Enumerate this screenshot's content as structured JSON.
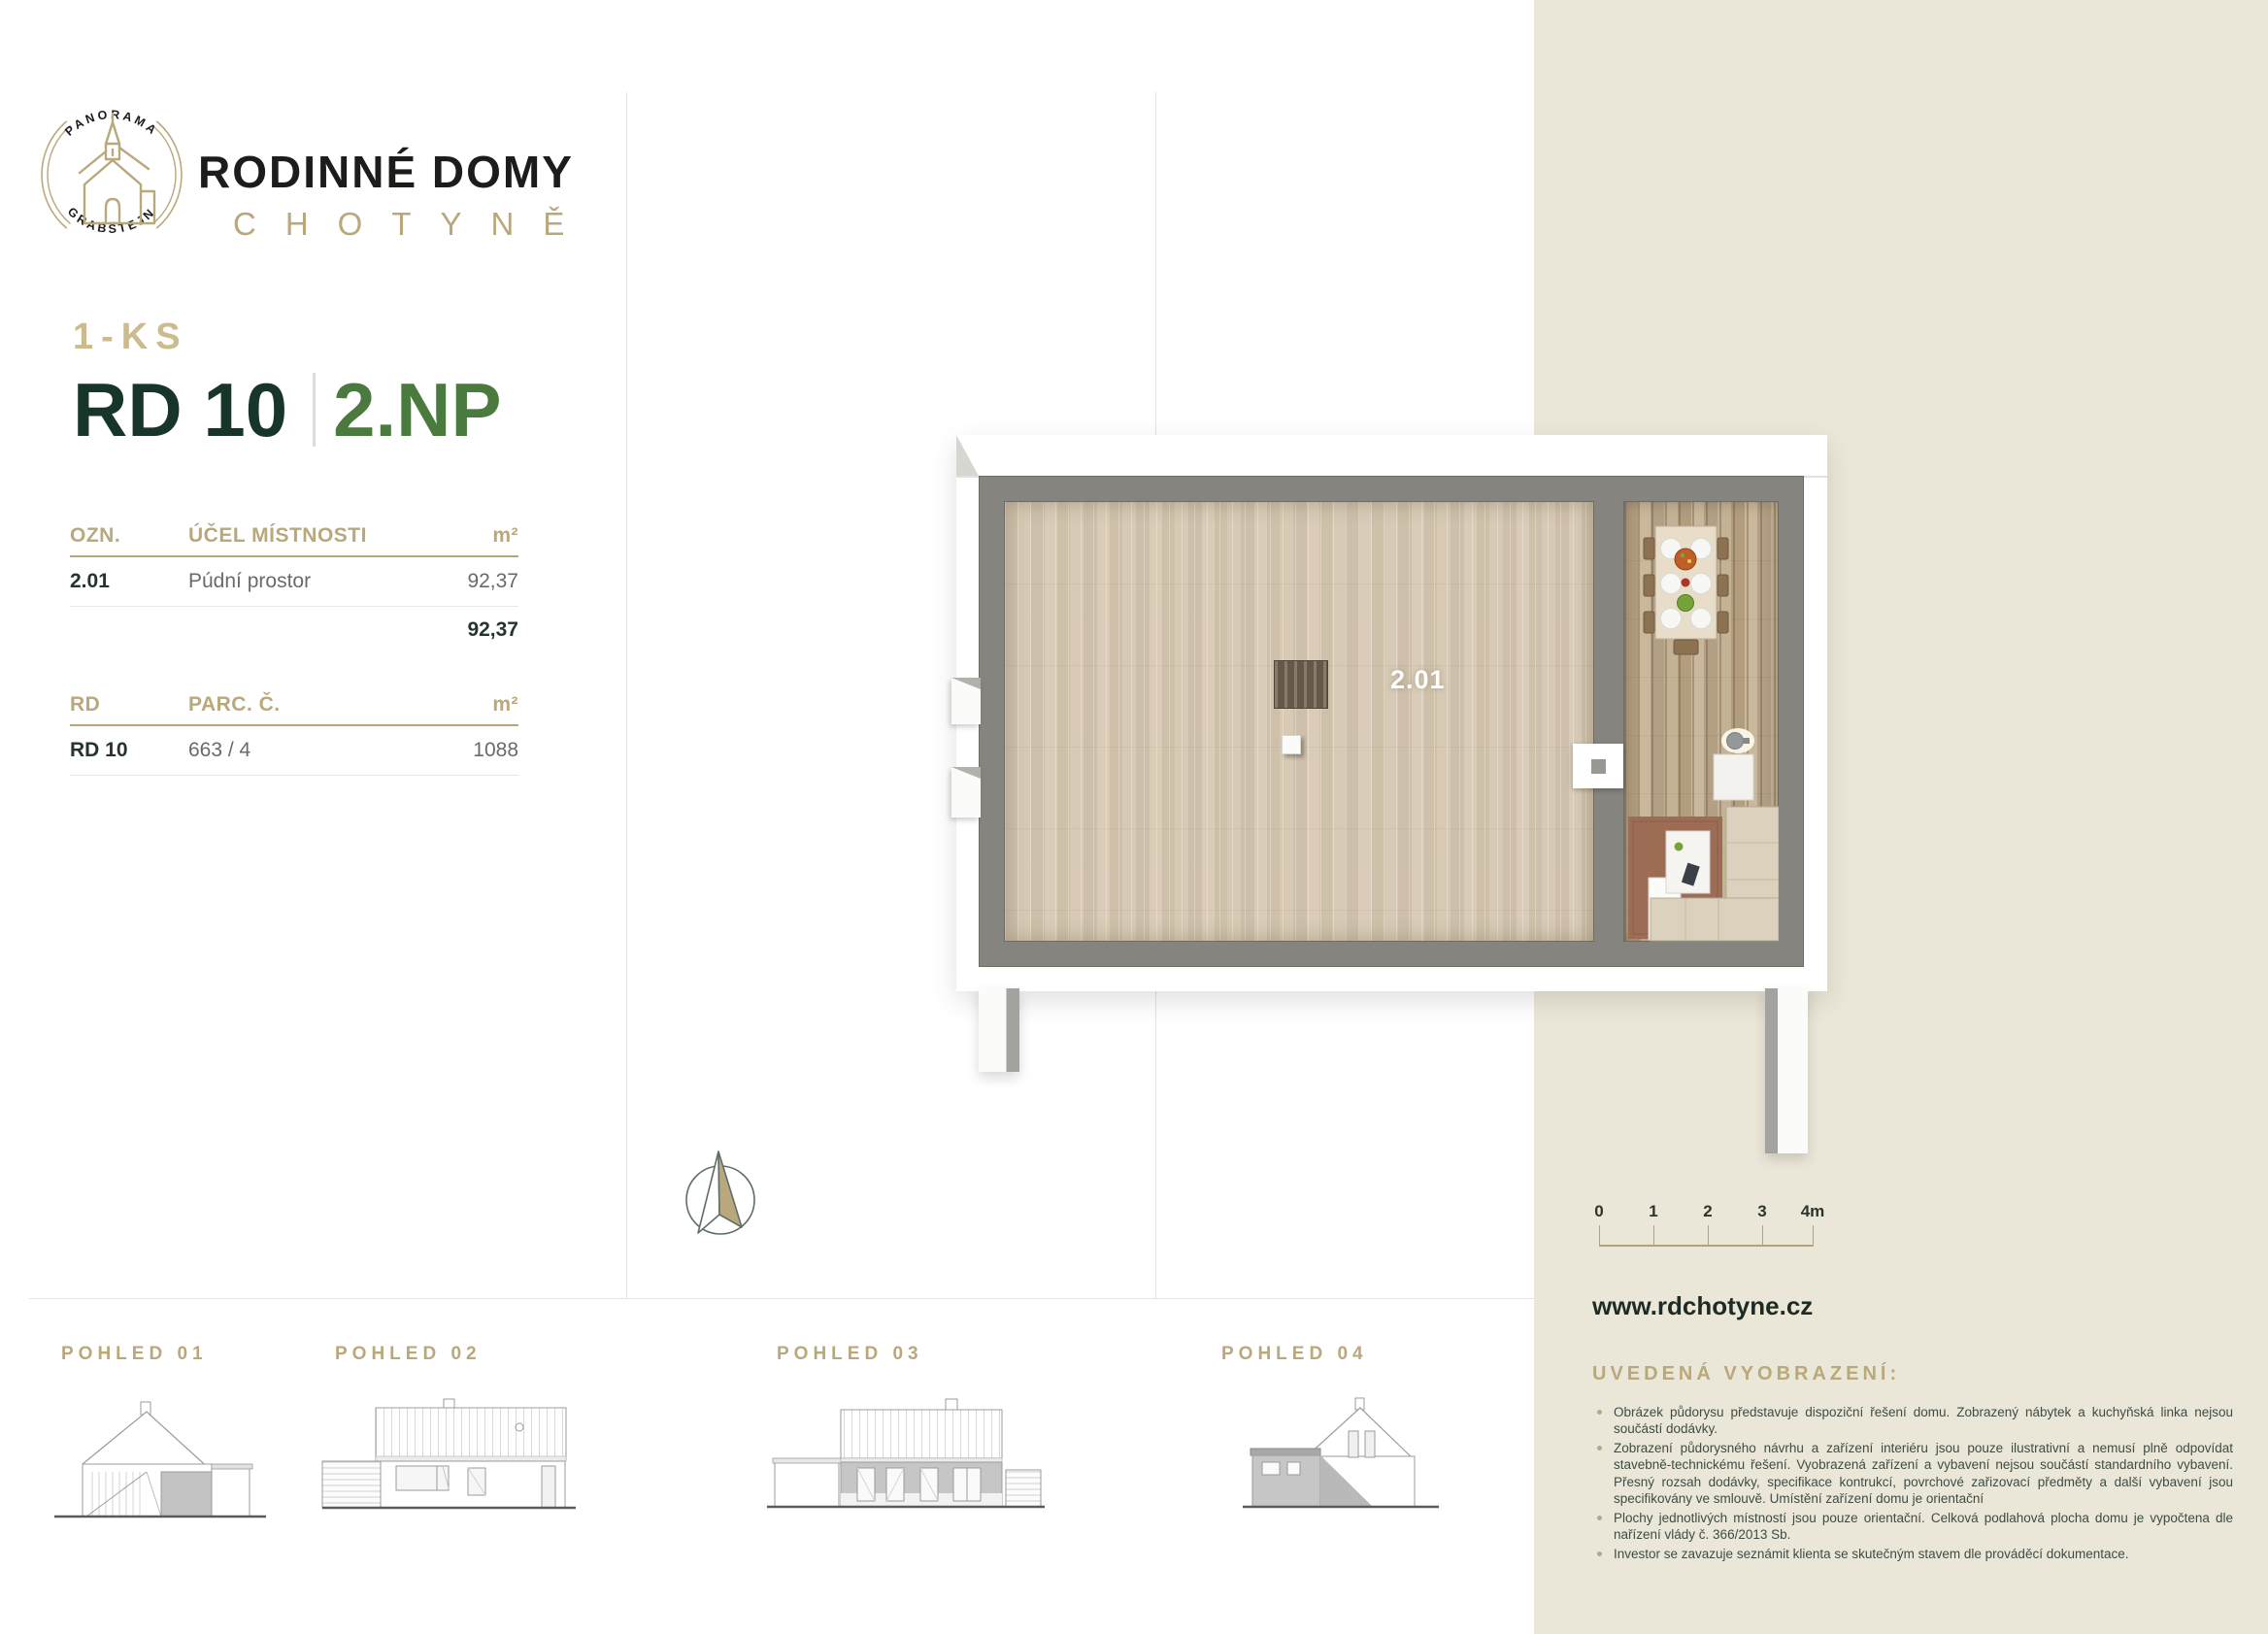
{
  "brand": {
    "badge": {
      "top_text": "PANORAMA",
      "bottom_text": "GRABŠTEJN"
    },
    "title": "RODINNÉ DOMY",
    "subtitle": "CHOTYNĚ"
  },
  "unit": {
    "type_label": "1-KS",
    "house": "RD 10",
    "floor": "2.NP"
  },
  "rooms_table": {
    "col_ozn": "OZN.",
    "col_purpose": "ÚČEL MÍSTNOSTI",
    "col_area": "m²",
    "rows": [
      {
        "ozn": "2.01",
        "purpose": "Púdní prostor",
        "area": "92,37"
      }
    ],
    "total_area": "92,37"
  },
  "parcel_table": {
    "col_rd": "RD",
    "col_parc": "PARC. Č.",
    "col_area": "m²",
    "rows": [
      {
        "rd": "RD 10",
        "parc": "663 / 4",
        "area": "1088"
      }
    ]
  },
  "floorplan": {
    "room_label": "2.01"
  },
  "scale_bar": {
    "ticks": [
      "0",
      "1",
      "2",
      "3",
      "4m"
    ]
  },
  "footer": {
    "website": "www.rdchotyne.cz"
  },
  "disclaimer": {
    "title": "UVEDENÁ VYOBRAZENÍ:",
    "items": [
      "Obrázek půdorysu představuje dispoziční řešení domu. Zobrazený nábytek a kuchyňská linka nejsou součástí dodávky.",
      "Zobrazení půdorysného návrhu a zařízení interiéru jsou pouze ilustrativní a nemusí plně odpovídat stavebně-technickému řešení. Vyobrazená zařízení a vybavení nejsou součástí standardního vybavení. Přesný rozsah dodávky, specifikace kontrukcí, povrchové zařizovací předměty a další vybavení jsou specifikovány ve smlouvě. Umístění zařízení domu je orientační",
      "Plochy jednotlivých místností jsou pouze orientační. Celková podlahová plocha domu je vypočtena dle nařízení vlády č. 366/2013 Sb.",
      "Investor se zavazuje seznámit klienta se skutečným stavem dle prováděcí dokumentace."
    ]
  },
  "views": [
    {
      "label": "POHLED 01"
    },
    {
      "label": "POHLED 02"
    },
    {
      "label": "POHLED 03"
    },
    {
      "label": "POHLED 04"
    }
  ],
  "colors": {
    "gold": "#b9a87b",
    "gold_light": "#cbbb8d",
    "dark_green": "#18352a",
    "green": "#4b7a3f",
    "beige": "#ebe7d8",
    "wall_gray": "#86847f"
  }
}
